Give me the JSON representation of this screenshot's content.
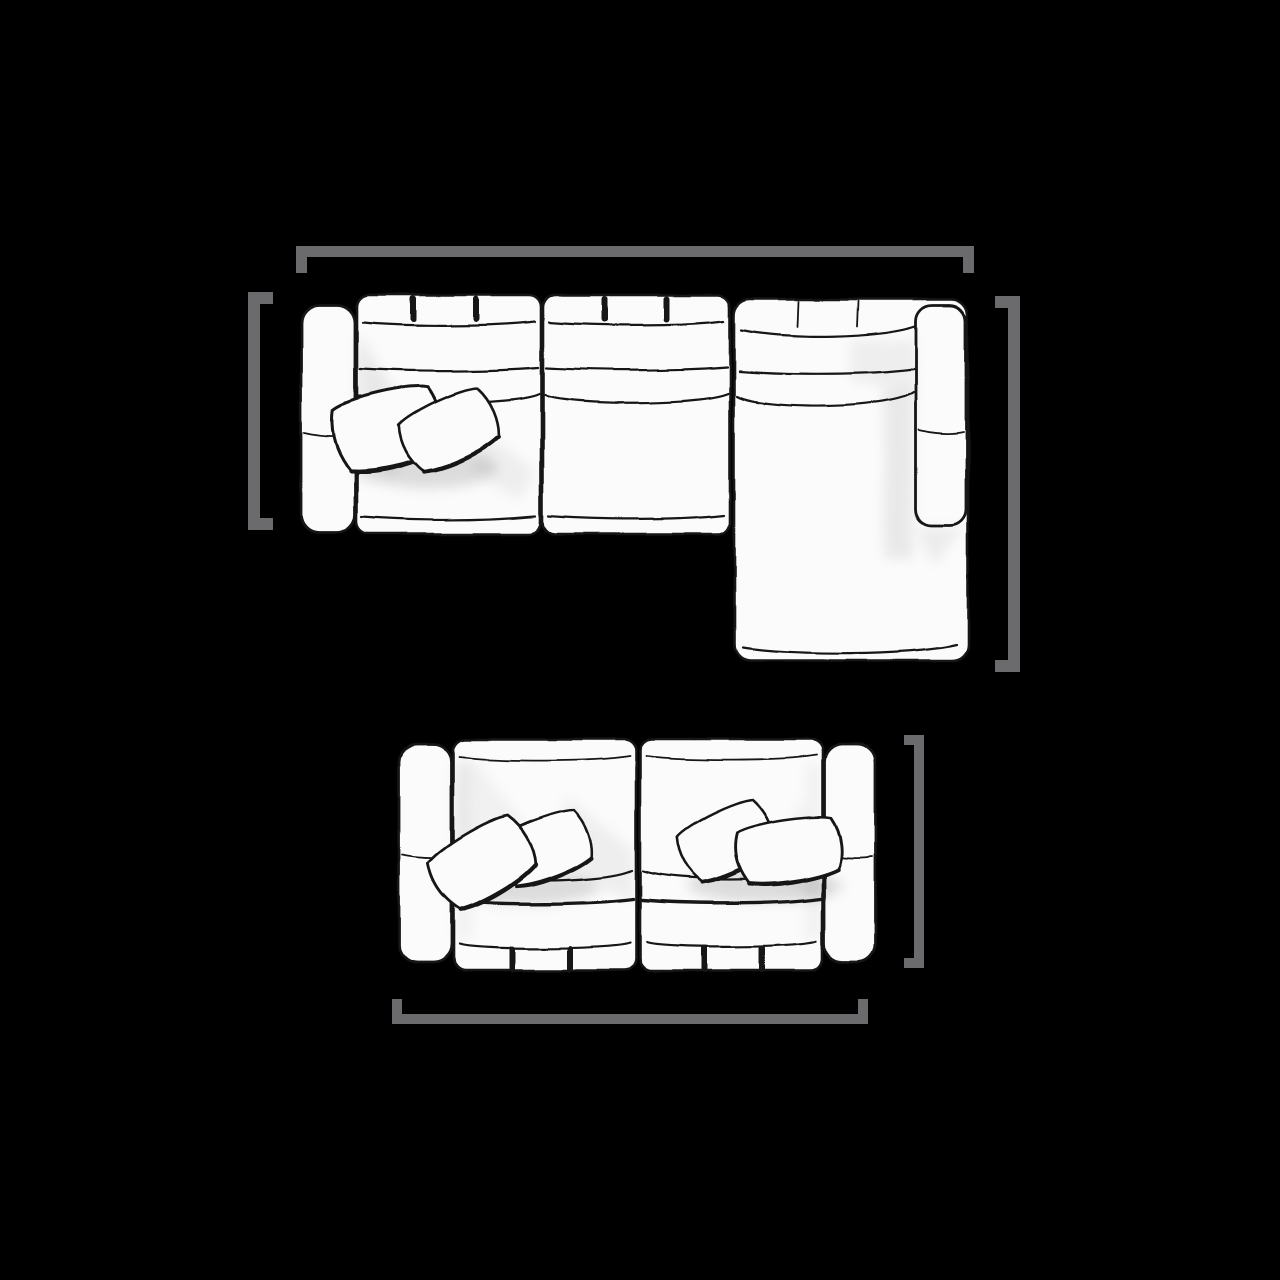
{
  "canvas": {
    "width": 1280,
    "height": 1280,
    "background": "#000000"
  },
  "diagram": {
    "description": "Top view line drawing of a modular sectional sofa with right chaise (above) and a two seat modular sofa (below), each outlined by gray dimension brackets",
    "colors": {
      "background": "#000000",
      "bracket": "#6b6b6d",
      "outline": "#151515",
      "fill": "#fbfbfb"
    },
    "sectional": {
      "name": "sectional sofa with right chaise, top view",
      "modules": [
        "left arm",
        "seat module with two throw pillows",
        "seat module",
        "chaise module",
        "right arm"
      ],
      "pillow_count": 2,
      "tufting_marks_per_seat": 2,
      "brackets": [
        {
          "id": "overall-width",
          "side": "top",
          "orientation": "horizontal"
        },
        {
          "id": "body-depth",
          "side": "left",
          "orientation": "vertical"
        },
        {
          "id": "chaise-depth",
          "side": "right",
          "orientation": "vertical"
        }
      ]
    },
    "loveseat": {
      "name": "two seat sofa, top view",
      "modules": [
        "left arm",
        "seat module with two throw pillows",
        "seat module with two throw pillows",
        "right arm"
      ],
      "pillow_count": 4,
      "tufting_marks_per_seat": 2,
      "brackets": [
        {
          "id": "body-depth",
          "side": "right",
          "orientation": "vertical"
        },
        {
          "id": "overall-width",
          "side": "bottom",
          "orientation": "horizontal"
        }
      ]
    }
  }
}
